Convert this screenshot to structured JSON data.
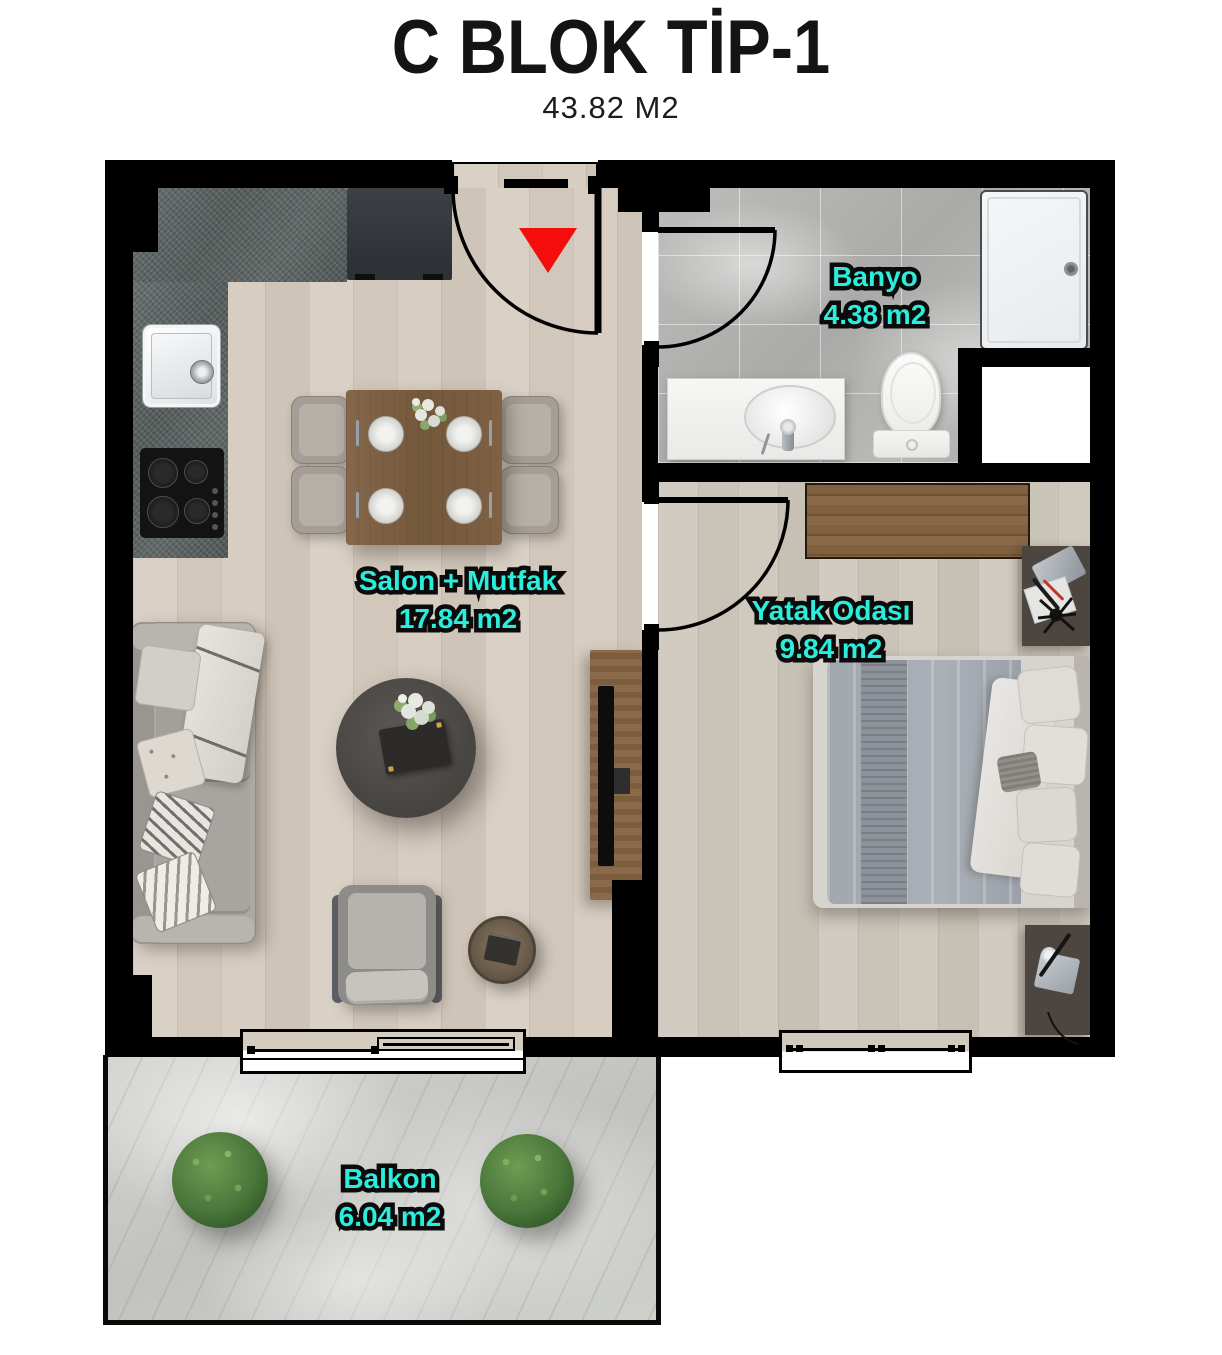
{
  "header": {
    "title": "C BLOK TİP-1",
    "subtitle": "43.82 M2"
  },
  "rooms": {
    "salon": {
      "name": "Salon + Mutfak",
      "area": "17.84 m2"
    },
    "banyo": {
      "name": "Banyo",
      "area": "4.38 m2"
    },
    "yatak": {
      "name": "Yatak Odası",
      "area": "9.84 m2"
    },
    "balkon": {
      "name": "Balkon",
      "area": "6.04 m2"
    }
  },
  "colors": {
    "label-teal": "#2CECDB",
    "wall-black": "#000000",
    "entry-red": "#F50D0D",
    "floor-wood": "#D6CCC0",
    "floor-tile": "#B5B5B3",
    "floor-balcony": "#CDCEC9"
  },
  "icons": {
    "entrance_marker": "red-triangle-down"
  }
}
